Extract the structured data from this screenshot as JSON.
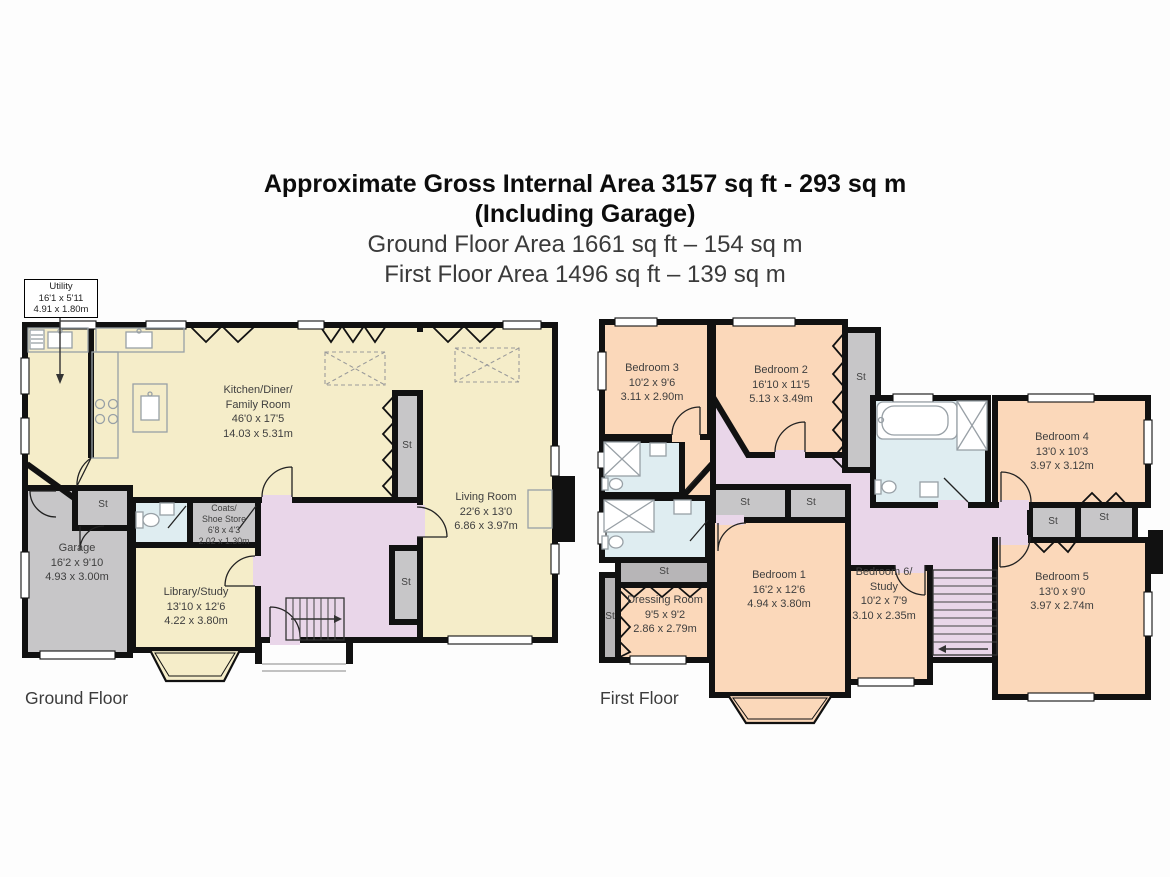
{
  "header": {
    "title_line1": "Approximate Gross Internal Area 3157 sq ft - 293 sq m",
    "title_line2": "(Including Garage)",
    "subtitle_line1": "Ground Floor Area 1661 sq ft – 154 sq m",
    "subtitle_line2": "First Floor Area 1496 sq ft – 139 sq m"
  },
  "labels": {
    "st": "St"
  },
  "ground_floor": {
    "label": "Ground Floor",
    "rooms": {
      "utility": {
        "name": "Utility",
        "ft": "16'1 x 5'11",
        "m": "4.91 x 1.80m"
      },
      "kitchen": {
        "name": "Kitchen/Diner/\nFamily Room",
        "ft": "46'0 x 17'5",
        "m": "14.03 x 5.31m"
      },
      "living": {
        "name": "Living Room",
        "ft": "22'6 x 13'0",
        "m": "6.86 x 3.97m"
      },
      "coats": {
        "name": "Coats/\nShoe Store",
        "ft": "6'8 x 4'3",
        "m": "2.02 x 1.30m"
      },
      "garage": {
        "name": "Garage",
        "ft": "16'2 x 9'10",
        "m": "4.93 x 3.00m"
      },
      "library": {
        "name": "Library/Study",
        "ft": "13'10 x 12'6",
        "m": "4.22 x 3.80m"
      }
    }
  },
  "first_floor": {
    "label": "First Floor",
    "rooms": {
      "bedroom1": {
        "name": "Bedroom 1",
        "ft": "16'2 x 12'6",
        "m": "4.94 x 3.80m"
      },
      "bedroom2": {
        "name": "Bedroom 2",
        "ft": "16'10 x 11'5",
        "m": "5.13 x 3.49m"
      },
      "bedroom3": {
        "name": "Bedroom 3",
        "ft": "10'2 x 9'6",
        "m": "3.11 x 2.90m"
      },
      "bedroom4": {
        "name": "Bedroom 4",
        "ft": "13'0 x 10'3",
        "m": "3.97 x 3.12m"
      },
      "bedroom5": {
        "name": "Bedroom 5",
        "ft": "13'0 x 9'0",
        "m": "3.97 x 2.74m"
      },
      "bedroom6": {
        "name": "Bedroom 6/\nStudy",
        "ft": "10'2 x 7'9",
        "m": "3.10 x 2.35m"
      },
      "dressing": {
        "name": "Dressing Room",
        "ft": "9'5 x 9'2",
        "m": "2.86 x 2.79m"
      }
    }
  },
  "colors": {
    "ground_rooms": "#f5edc9",
    "bedrooms": "#fbd8ba",
    "hall_landing": "#e9d6e9",
    "bathrooms": "#dfedf1",
    "storage_garage": "#c7c6c8",
    "walls": "#111111",
    "background": "#fdfdfd"
  }
}
